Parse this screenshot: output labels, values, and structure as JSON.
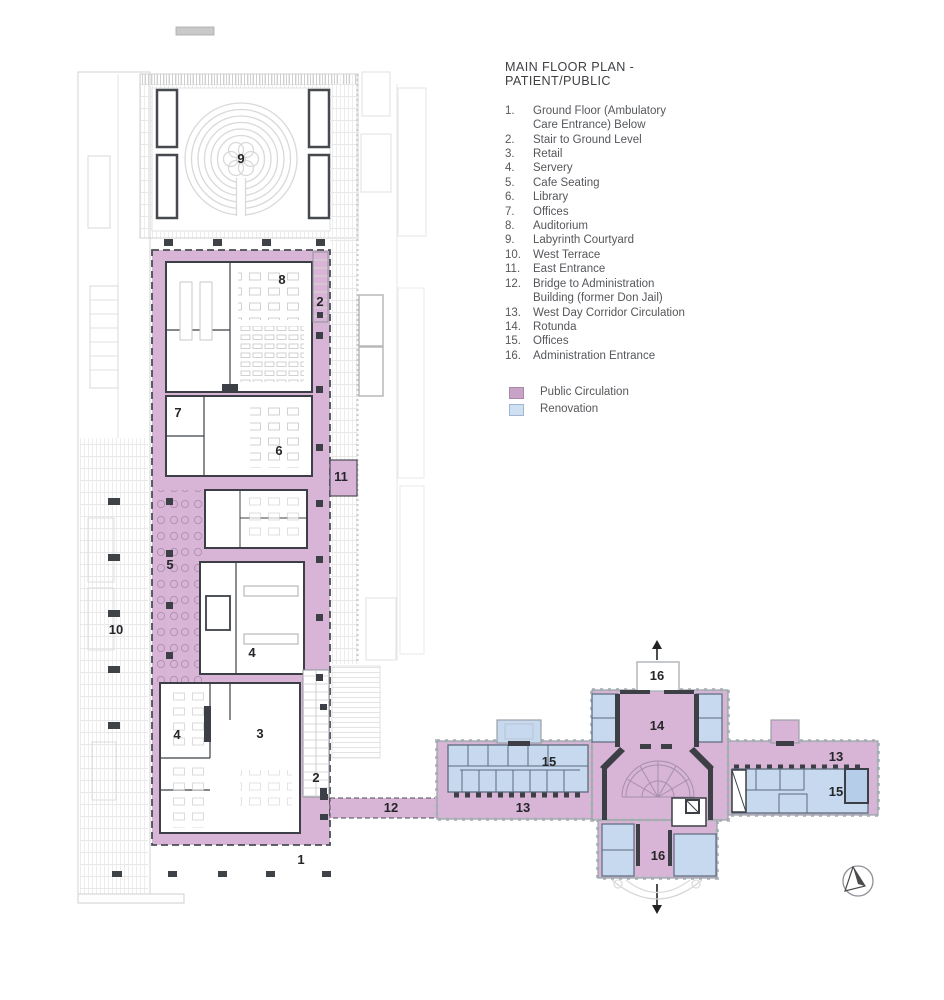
{
  "legend": {
    "title": "MAIN FLOOR PLAN - PATIENT/PUBLIC",
    "items": [
      {
        "num": "1.",
        "label": "Ground Floor (Ambulatory Care Entrance) Below"
      },
      {
        "num": "2.",
        "label": "Stair to Ground Level"
      },
      {
        "num": "3.",
        "label": "Retail"
      },
      {
        "num": "4.",
        "label": "Servery"
      },
      {
        "num": "5.",
        "label": "Cafe Seating"
      },
      {
        "num": "6.",
        "label": "Library"
      },
      {
        "num": "7.",
        "label": "Offices"
      },
      {
        "num": "8.",
        "label": "Auditorium"
      },
      {
        "num": "9.",
        "label": "Labyrinth Courtyard"
      },
      {
        "num": "10.",
        "label": "West Terrace"
      },
      {
        "num": "11.",
        "label": "East Entrance"
      },
      {
        "num": "12.",
        "label": "Bridge to Administration Building (former Don Jail)"
      },
      {
        "num": "13.",
        "label": "West Day Corridor Circulation"
      },
      {
        "num": "14.",
        "label": "Rotunda"
      },
      {
        "num": "15.",
        "label": "Offices"
      },
      {
        "num": "16.",
        "label": "Administration Entrance"
      }
    ],
    "swatches": [
      {
        "label": "Public Circulation",
        "style": "background:#c9a3c7;border:1px solid #ab88a9;"
      },
      {
        "label": "Renovation",
        "style": "background:#cfe0f2;border:1px solid #9fb6d2;"
      }
    ]
  },
  "plan": {
    "markers": {
      "ground_floor_below": "1",
      "stair_top": "2",
      "stair_bottom": "2",
      "retail": "3",
      "servery": "4",
      "servery_2": "4",
      "cafe_seating": "5",
      "library": "6",
      "offices_west": "7",
      "auditorium": "8",
      "labyrinth_courtyard": "9",
      "west_terrace": "10",
      "east_entrance": "11",
      "bridge": "12",
      "west_day_corridor": "13",
      "west_day_corridor_2": "13",
      "rotunda": "14",
      "offices_admin_west": "15",
      "offices_admin_east": "15",
      "admin_entrance_north": "16",
      "admin_entrance_south": "16"
    }
  },
  "colors": {
    "public_circulation": "#d8b4d6",
    "renovation": "#c6d9ef",
    "walls": "#3c4046",
    "site_lines": "#d3d3d3"
  }
}
